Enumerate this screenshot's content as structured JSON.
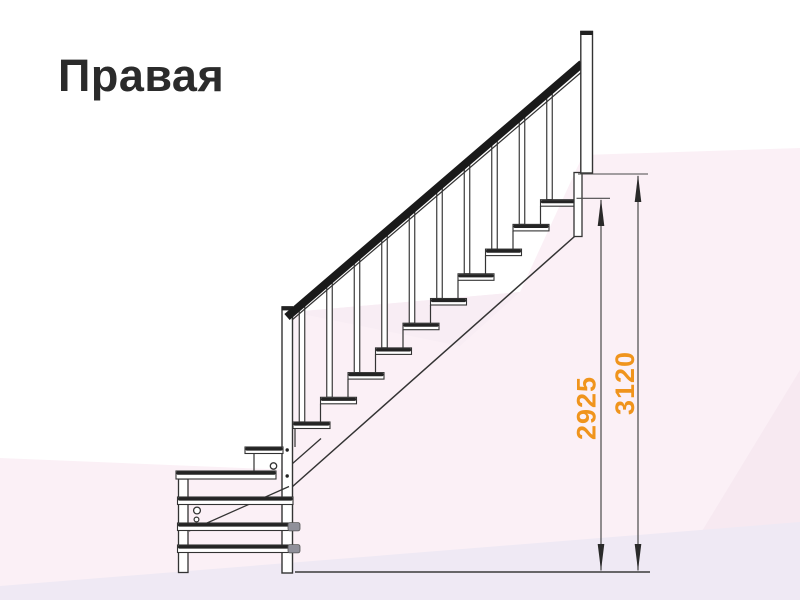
{
  "title": "Правая",
  "dimensions": {
    "inner": {
      "value": "2925"
    },
    "outer": {
      "value": "3120"
    }
  },
  "colors": {
    "dimension_text": "#F0941C",
    "drawing_line": "#333333",
    "title_text": "#2B2B2B",
    "background_tint_pink": "#FBF0F6",
    "background_tint_lavender": "#EFE9F4"
  }
}
